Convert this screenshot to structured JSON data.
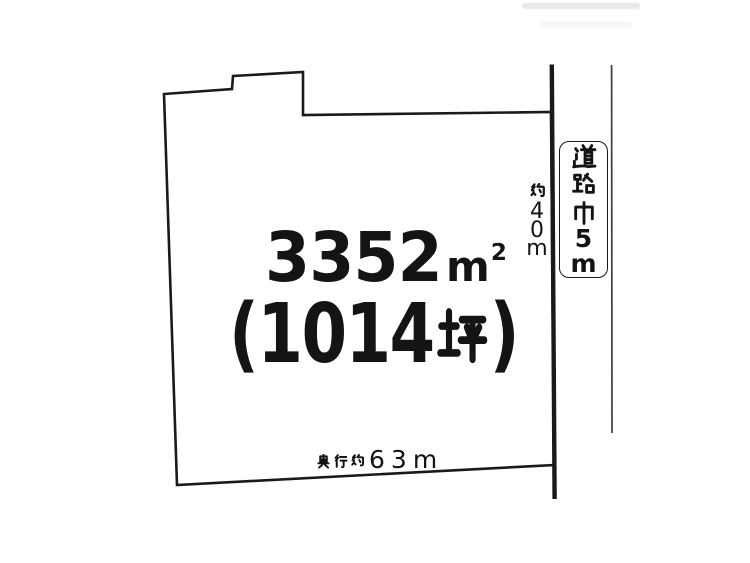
{
  "diagram": {
    "background_color": "#ffffff",
    "line_color": "#1a1a1a",
    "text_color": "#141414",
    "area": {
      "value": "3352",
      "unit_base": "m",
      "unit_exponent": "2"
    },
    "tsubo_label": "(1014坪)",
    "depth_label": "奥行約63m",
    "frontage_label": "約40m",
    "road_width_label": "道路巾5m"
  }
}
